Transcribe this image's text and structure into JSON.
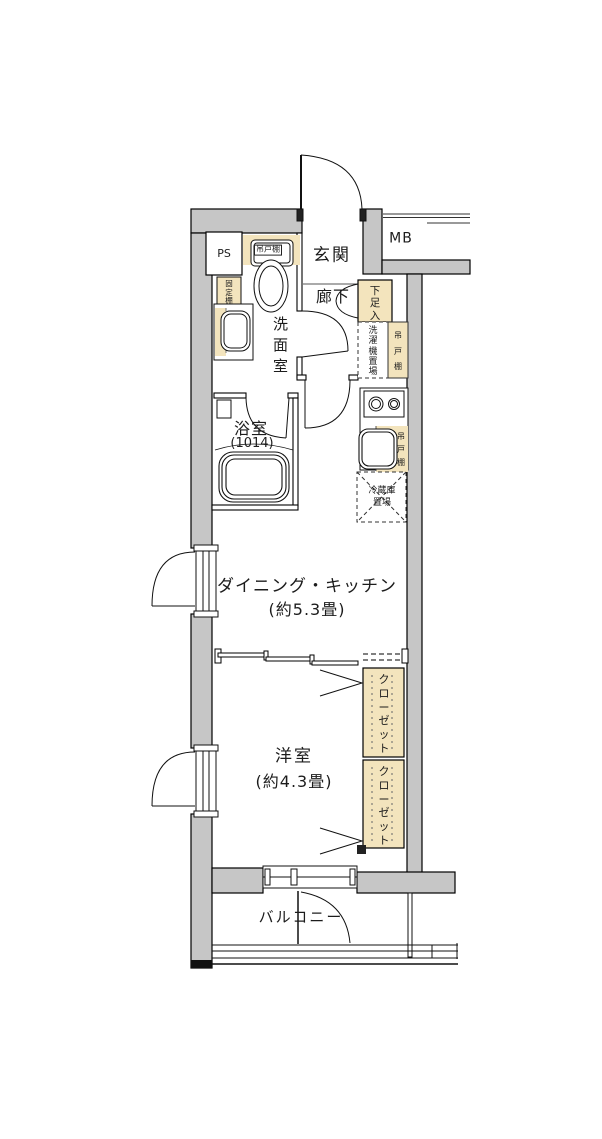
{
  "fp": {
    "colors": {
      "wall": "#c6c6c6",
      "cabinet": "#f3e4bd",
      "line": "#111111"
    },
    "rooms": {
      "entrance": {
        "label": "玄関"
      },
      "hallway": {
        "label": "廊下"
      },
      "washroom": {
        "label": "洗面室"
      },
      "bathroom": {
        "label": "浴室",
        "size": "(1014)"
      },
      "dining_kitchen": {
        "label": "ダイニング・キッチン",
        "size": "(約5.3畳)"
      },
      "western_room": {
        "label": "洋室",
        "size": "(約4.3畳)"
      },
      "balcony": {
        "label": "バルコニー"
      },
      "meter_box": {
        "label": "MB"
      },
      "pipe_space": {
        "label": "PS"
      }
    },
    "fixtures": {
      "shoe_cabinet": "下足入",
      "hanging_cupboard_washroom": "吊戸棚",
      "hanging_cupboard_hall": "吊戸棚",
      "hanging_cupboard_kitchen": "吊戸棚",
      "fixed_shelf": "固定棚",
      "washing_machine_area": "洗濯機置場",
      "refrigerator_area_line1": "冷蔵庫",
      "refrigerator_area_line2": "置場",
      "closet_upper": "クローゼット",
      "closet_lower": "クローゼット"
    }
  }
}
